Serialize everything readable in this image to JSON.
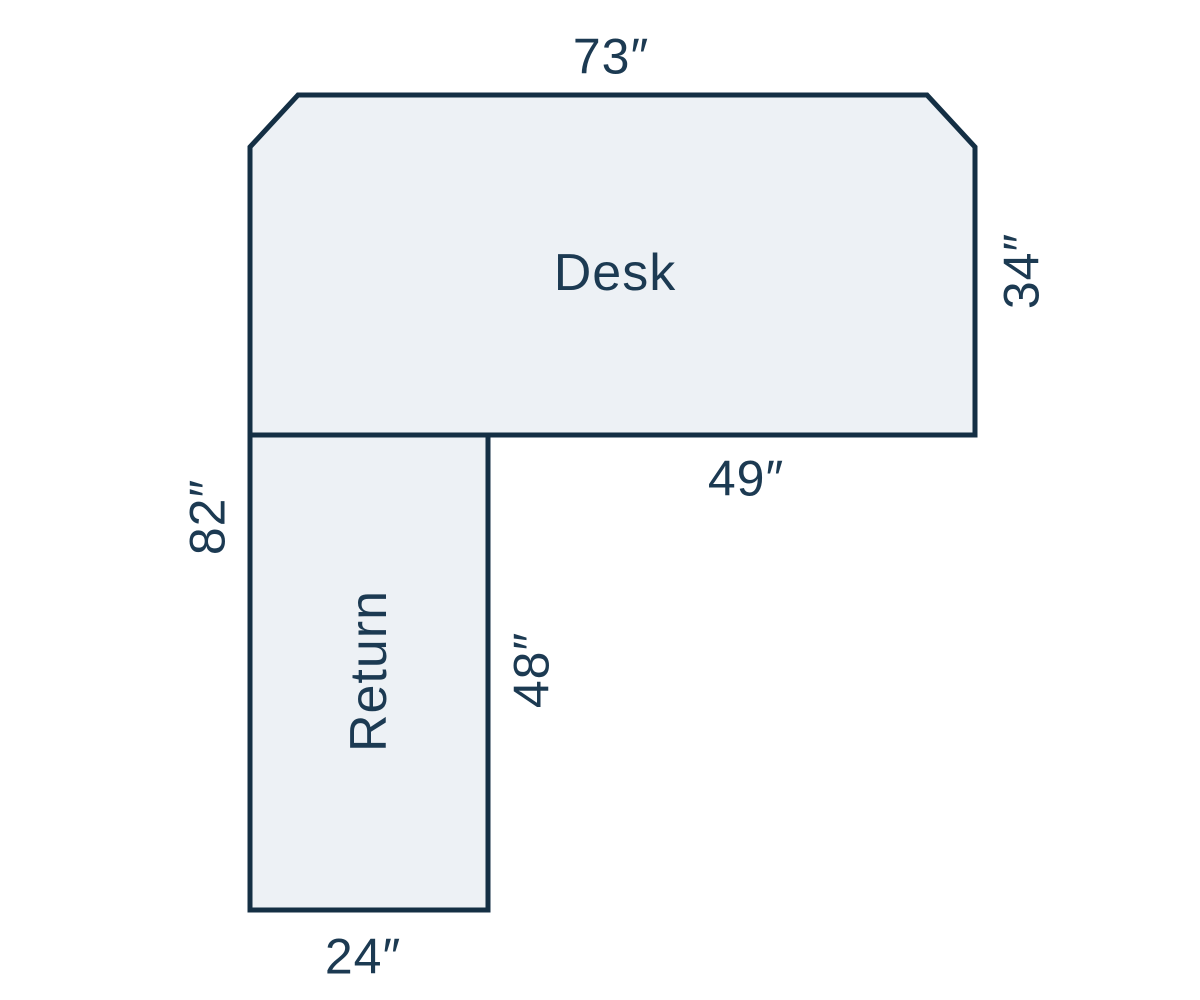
{
  "diagram": {
    "type": "desk-floorplan",
    "shapes": {
      "desk": {
        "label": "Desk",
        "dims": {
          "top_width": "73″",
          "right_depth": "34″",
          "bottom_width": "49″"
        }
      },
      "return": {
        "label": "Return",
        "dims": {
          "left_height": "82″",
          "right_height": "48″",
          "bottom_width": "24″"
        }
      }
    },
    "colors": {
      "surface_fill": "#edf1f5",
      "outline": "#142f44",
      "label_text": "#1c3a52",
      "background": "#ffffff"
    }
  }
}
